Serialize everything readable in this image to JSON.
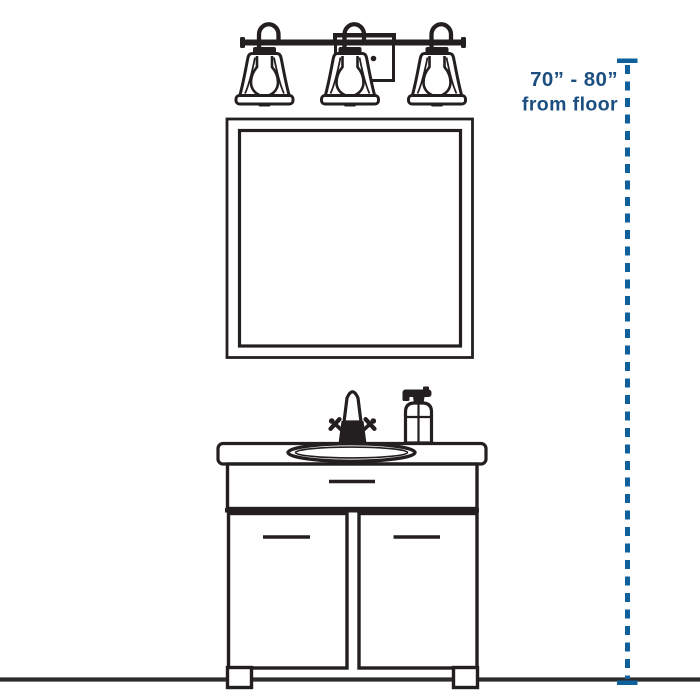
{
  "page": {
    "background": "#ffffff",
    "description": "Vanity light mounting-height installation diagram"
  },
  "diagram": {
    "annotation": {
      "line1": "70” - 80”",
      "line2": "from floor"
    },
    "colors": {
      "line_art": "#231f20",
      "floor_line": "#2d2d2d",
      "dimension_blue": "#10609c",
      "text_blue": "#1c4f80",
      "background": "#ffffff"
    },
    "components": {
      "fixture": "three-light vanity fixture",
      "mirror": "square wall mirror",
      "faucet": "two-handle bathroom faucet",
      "soap": "soap pump bottle",
      "sink": "oval drop-in sink",
      "cabinet": "two-door vanity cabinet with drawer",
      "floor": "floor line",
      "dimension": "dashed height dimension line"
    }
  }
}
